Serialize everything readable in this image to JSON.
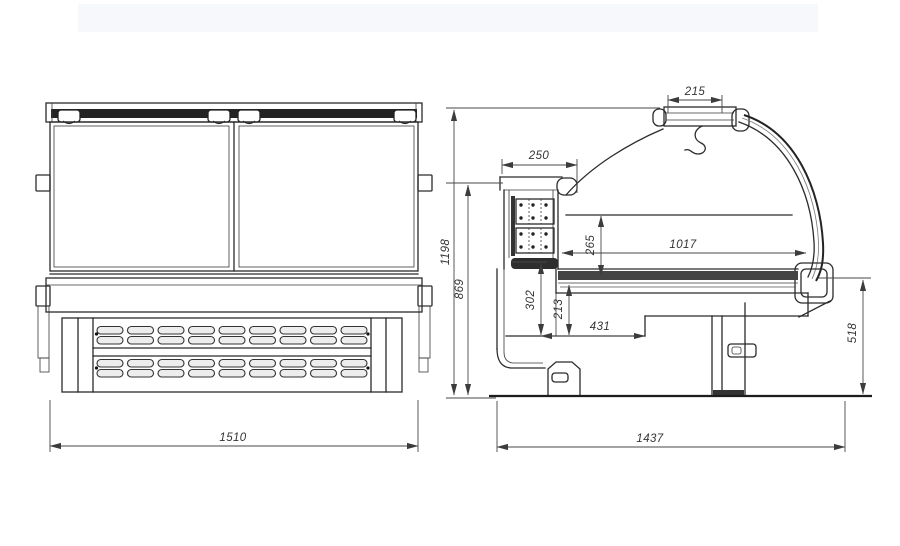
{
  "drawing": {
    "background": "#ffffff",
    "line_color": "#2b2b2b",
    "dim_color": "#474747",
    "dark_band_color": "#232323",
    "deck_band_color": "#454545",
    "front_view": {
      "overall_width": "1510"
    },
    "side_view": {
      "canopy_width": "215",
      "rear_duct_width": "250",
      "overall_height": "1198",
      "worktop_height": "869",
      "display_opening_height": "265",
      "display_shelf_depth": "1017",
      "lower_section_height": "302",
      "base_inner_height": "213",
      "base_shelf_depth": "431",
      "front_panel_height": "518",
      "overall_depth": "1437"
    }
  }
}
